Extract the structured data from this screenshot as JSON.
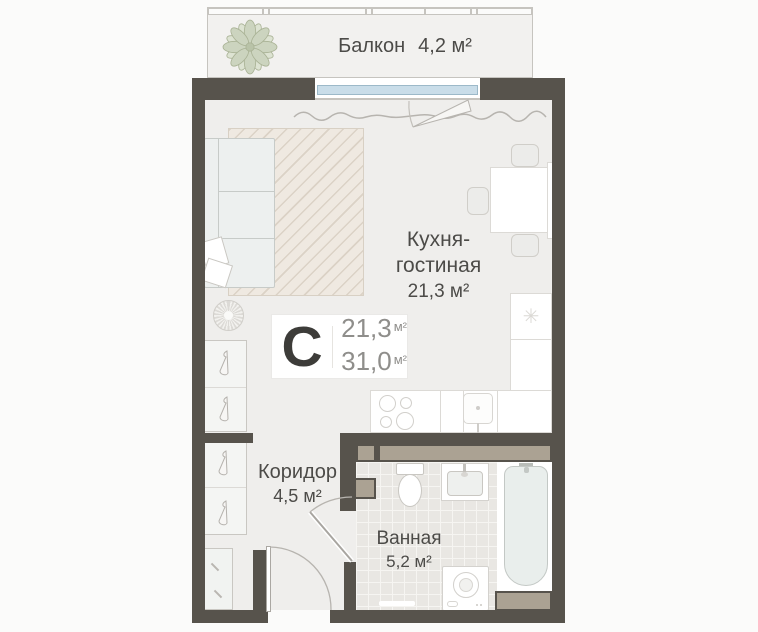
{
  "unit_card": {
    "type_label": "С",
    "living_value": "21,3",
    "total_value": "31,0",
    "unit": "м²"
  },
  "rooms": {
    "balcony": {
      "name": "Балкон",
      "area": "4,2 м²"
    },
    "kitchen_living": {
      "name_line1": "Кухня-",
      "name_line2": "гостиная",
      "area": "21,3 м²"
    },
    "corridor": {
      "name": "Коридор",
      "area": "4,5 м²"
    },
    "bathroom": {
      "name": "Ванная",
      "area": "5,2 м²"
    }
  },
  "icons": {
    "fridge_snowflake": "✳"
  },
  "colors": {
    "wall": "#57534c",
    "vent_shaft": "#aba293",
    "window_glass": "#c9dde9",
    "floor": "#efeeec",
    "tile": "#e9e7e3",
    "label_text": "#4c4b48",
    "plant_green": "#ccd4bf"
  }
}
